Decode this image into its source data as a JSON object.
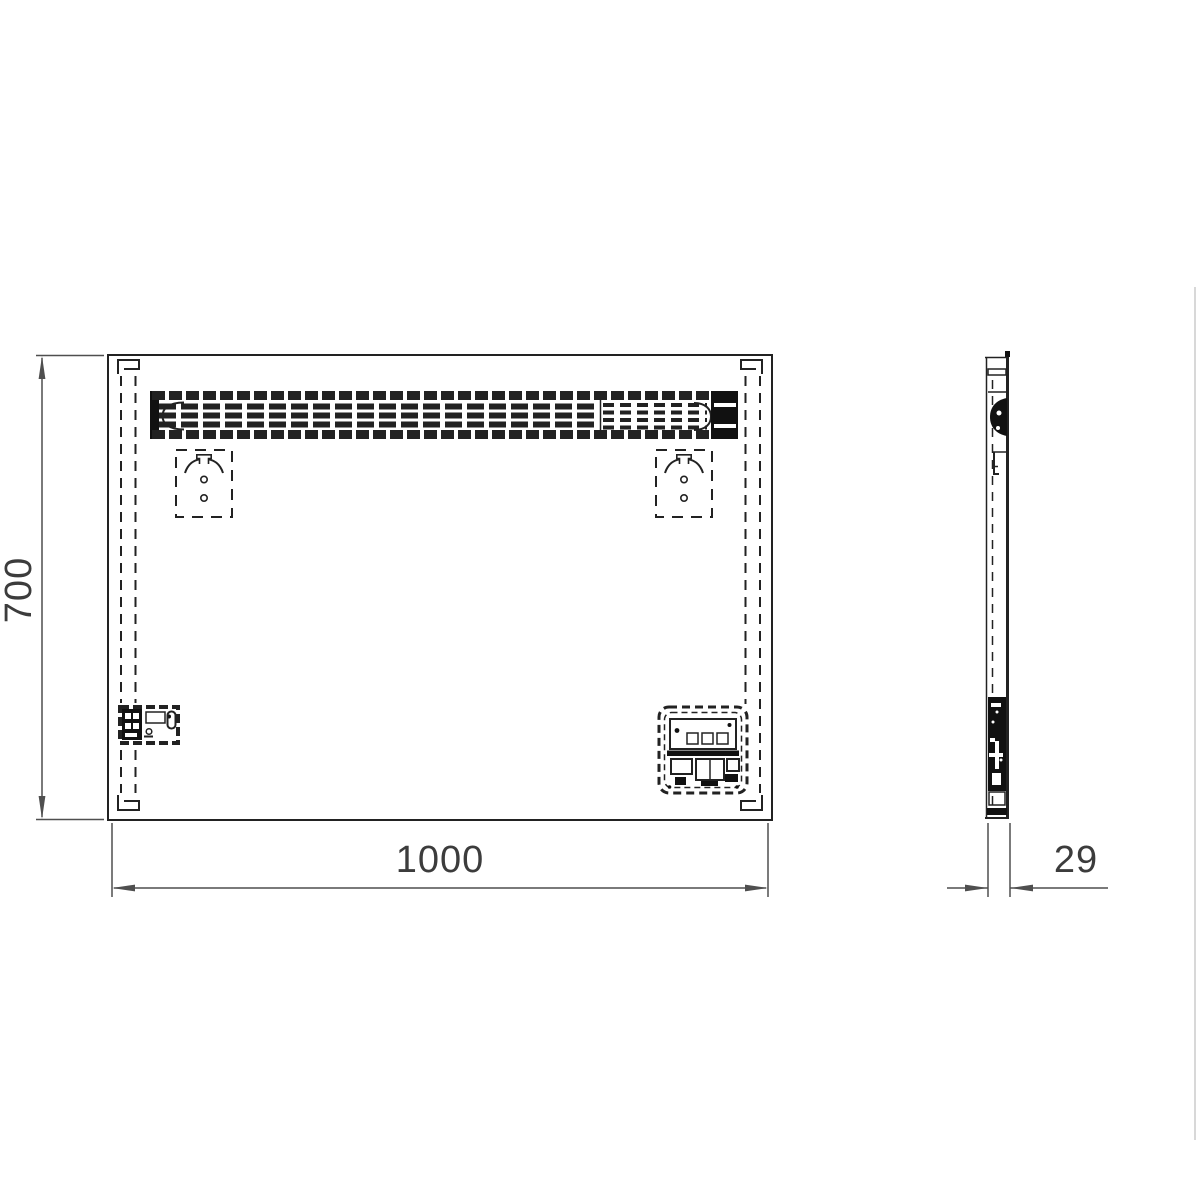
{
  "dimensions": {
    "height": "700",
    "width": "1000",
    "depth": "29"
  },
  "colors": {
    "line": "#222222",
    "dimension": "#4f4f4f",
    "text": "#3c3c3c",
    "dark": "#111111",
    "background": "#ffffff"
  },
  "parts": {
    "front_view": "front-elevation",
    "side_view": "side-profile",
    "light_bar": "fluorescent-light-bar",
    "hangers": "keyhole-hanger-bracket",
    "switch_box": "pull-cord-switch-box",
    "junction_box": "terminal-junction-box",
    "mounting_strips": "wall-mounting-strip"
  }
}
